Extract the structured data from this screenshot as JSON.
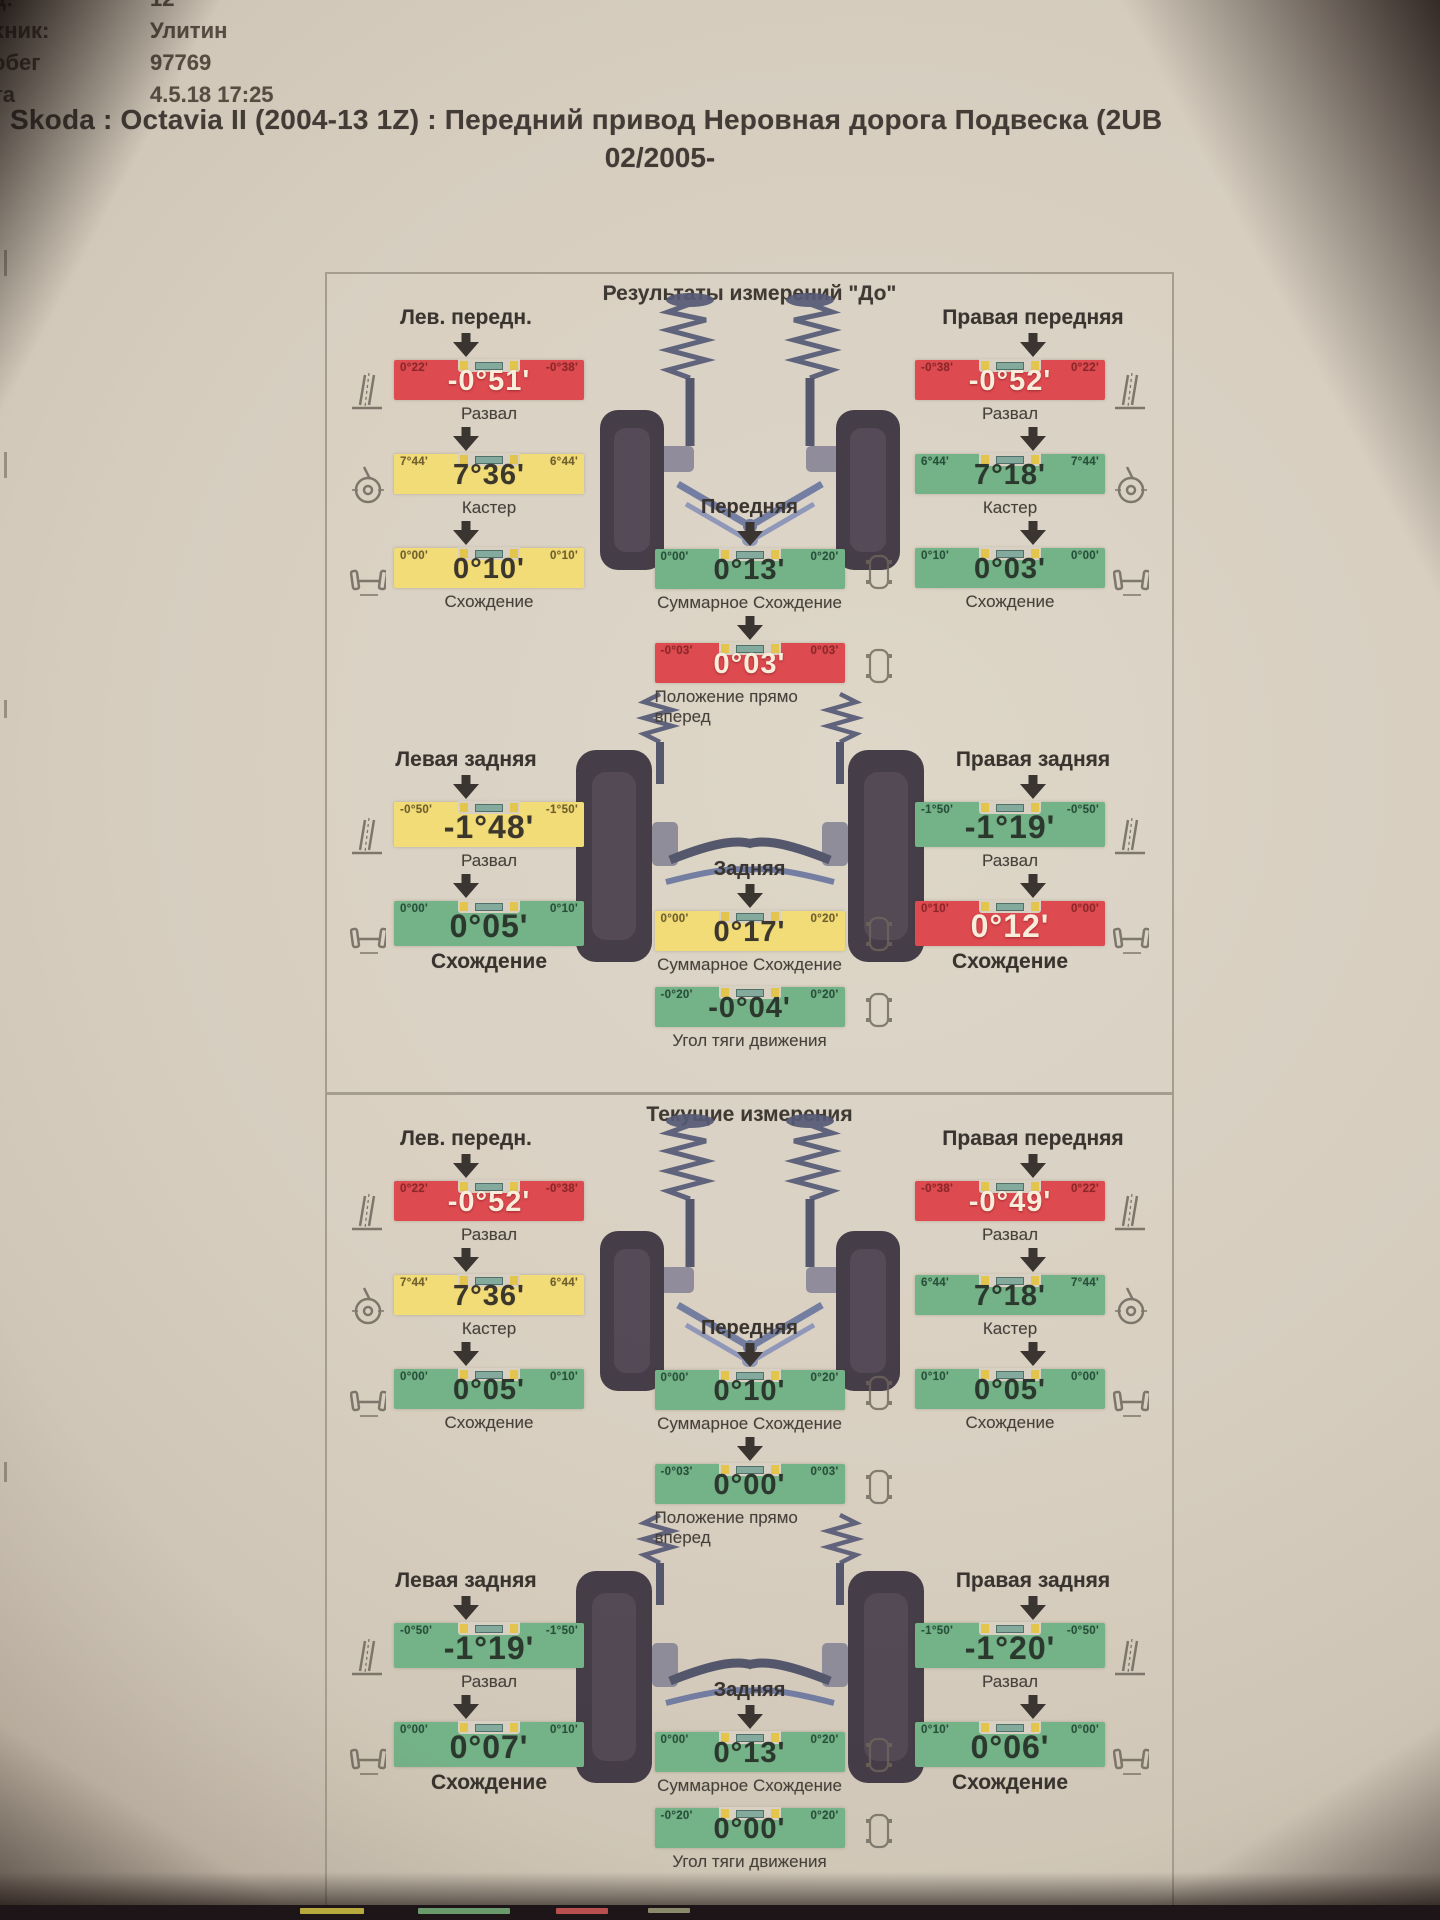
{
  "meta": {
    "rows": [
      {
        "label": "д:",
        "value": "12"
      },
      {
        "label": "хник:",
        "value": "Улитин"
      },
      {
        "label": "обег",
        "value": "97769"
      },
      {
        "label": "та",
        "value": "4.5.18 17:25"
      }
    ]
  },
  "title": {
    "line1": "Skoda : Octavia II (2004-13 1Z) : Передний привод Неровная дорога Подвеска (2UB",
    "line2": "02/2005-"
  },
  "colors": {
    "red": "#dd4a50",
    "yellow": "#f2dc77",
    "green": "#74b287",
    "paper": "#d8d0c2"
  },
  "icons": {
    "down_arrow": "▼",
    "side_icons": [
      "camber-icon",
      "caster-icon",
      "toe-icon",
      "car-top-icon"
    ]
  },
  "p1": {
    "title": "Результаты измерений \"До\"",
    "front_left": {
      "header": "Лев. передн.",
      "camber": {
        "caption": "Развал",
        "value": "-0°51'",
        "left": "0°22'",
        "right": "-0°38'",
        "color": "red"
      },
      "caster": {
        "caption": "Кастер",
        "value": "7°36'",
        "left": "7°44'",
        "right": "6°44'",
        "color": "yellow"
      },
      "toe": {
        "caption": "Схождение",
        "value": "0°10'",
        "left": "0°00'",
        "right": "0°10'",
        "color": "yellow"
      }
    },
    "front_right": {
      "header": "Правая передняя",
      "camber": {
        "caption": "Развал",
        "value": "-0°52'",
        "left": "-0°38'",
        "right": "0°22'",
        "color": "red"
      },
      "caster": {
        "caption": "Кастер",
        "value": "7°18'",
        "left": "6°44'",
        "right": "7°44'",
        "color": "green"
      },
      "toe": {
        "caption": "Схождение",
        "value": "0°03'",
        "left": "0°10'",
        "right": "0°00'",
        "color": "green"
      }
    },
    "front_center": {
      "header": "Передняя",
      "total_toe": {
        "caption": "Суммарное Схождение",
        "value": "0°13'",
        "left": "0°00'",
        "right": "0°20'",
        "color": "green"
      },
      "straight": {
        "caption": "Положение прямо вперед",
        "value": "0°03'",
        "left": "-0°03'",
        "right": "0°03'",
        "color": "red"
      }
    },
    "rear_left": {
      "header": "Левая задняя",
      "camber": {
        "caption": "Развал",
        "value": "-1°48'",
        "left": "-0°50'",
        "right": "-1°50'",
        "color": "yellow"
      },
      "toe": {
        "caption": "Схождение",
        "value": "0°05'",
        "left": "0°00'",
        "right": "0°10'",
        "color": "green",
        "big": true
      }
    },
    "rear_right": {
      "header": "Правая задняя",
      "camber": {
        "caption": "Развал",
        "value": "-1°19'",
        "left": "-1°50'",
        "right": "-0°50'",
        "color": "green"
      },
      "toe": {
        "caption": "Схождение",
        "value": "0°12'",
        "left": "0°10'",
        "right": "0°00'",
        "color": "red",
        "big": true
      }
    },
    "rear_center": {
      "header": "Задняя",
      "total_toe": {
        "caption": "Суммарное Схождение",
        "value": "0°17'",
        "left": "0°00'",
        "right": "0°20'",
        "color": "yellow"
      },
      "thrust": {
        "caption": "Угол тяги движения",
        "value": "-0°04'",
        "left": "-0°20'",
        "right": "0°20'",
        "color": "green"
      }
    }
  },
  "p2": {
    "title": "Текущие измерения",
    "front_left": {
      "header": "Лев. передн.",
      "camber": {
        "caption": "Развал",
        "value": "-0°52'",
        "left": "0°22'",
        "right": "-0°38'",
        "color": "red"
      },
      "caster": {
        "caption": "Кастер",
        "value": "7°36'",
        "left": "7°44'",
        "right": "6°44'",
        "color": "yellow"
      },
      "toe": {
        "caption": "Схождение",
        "value": "0°05'",
        "left": "0°00'",
        "right": "0°10'",
        "color": "green"
      }
    },
    "front_right": {
      "header": "Правая передняя",
      "camber": {
        "caption": "Развал",
        "value": "-0°49'",
        "left": "-0°38'",
        "right": "0°22'",
        "color": "red"
      },
      "caster": {
        "caption": "Кастер",
        "value": "7°18'",
        "left": "6°44'",
        "right": "7°44'",
        "color": "green"
      },
      "toe": {
        "caption": "Схождение",
        "value": "0°05'",
        "left": "0°10'",
        "right": "0°00'",
        "color": "green"
      }
    },
    "front_center": {
      "header": "Передняя",
      "total_toe": {
        "caption": "Суммарное Схождение",
        "value": "0°10'",
        "left": "0°00'",
        "right": "0°20'",
        "color": "green"
      },
      "straight": {
        "caption": "Положение прямо вперед",
        "value": "0°00'",
        "left": "-0°03'",
        "right": "0°03'",
        "color": "green"
      }
    },
    "rear_left": {
      "header": "Левая задняя",
      "camber": {
        "caption": "Развал",
        "value": "-1°19'",
        "left": "-0°50'",
        "right": "-1°50'",
        "color": "green"
      },
      "toe": {
        "caption": "Схождение",
        "value": "0°07'",
        "left": "0°00'",
        "right": "0°10'",
        "color": "green",
        "big": true
      }
    },
    "rear_right": {
      "header": "Правая задняя",
      "camber": {
        "caption": "Развал",
        "value": "-1°20'",
        "left": "-1°50'",
        "right": "-0°50'",
        "color": "green"
      },
      "toe": {
        "caption": "Схождение",
        "value": "0°06'",
        "left": "0°10'",
        "right": "0°00'",
        "color": "green",
        "big": true
      }
    },
    "rear_center": {
      "header": "Задняя",
      "total_toe": {
        "caption": "Суммарное Схождение",
        "value": "0°13'",
        "left": "0°00'",
        "right": "0°20'",
        "color": "green"
      },
      "thrust": {
        "caption": "Угол тяги движения",
        "value": "0°00'",
        "left": "-0°20'",
        "right": "0°20'",
        "color": "green"
      }
    }
  }
}
